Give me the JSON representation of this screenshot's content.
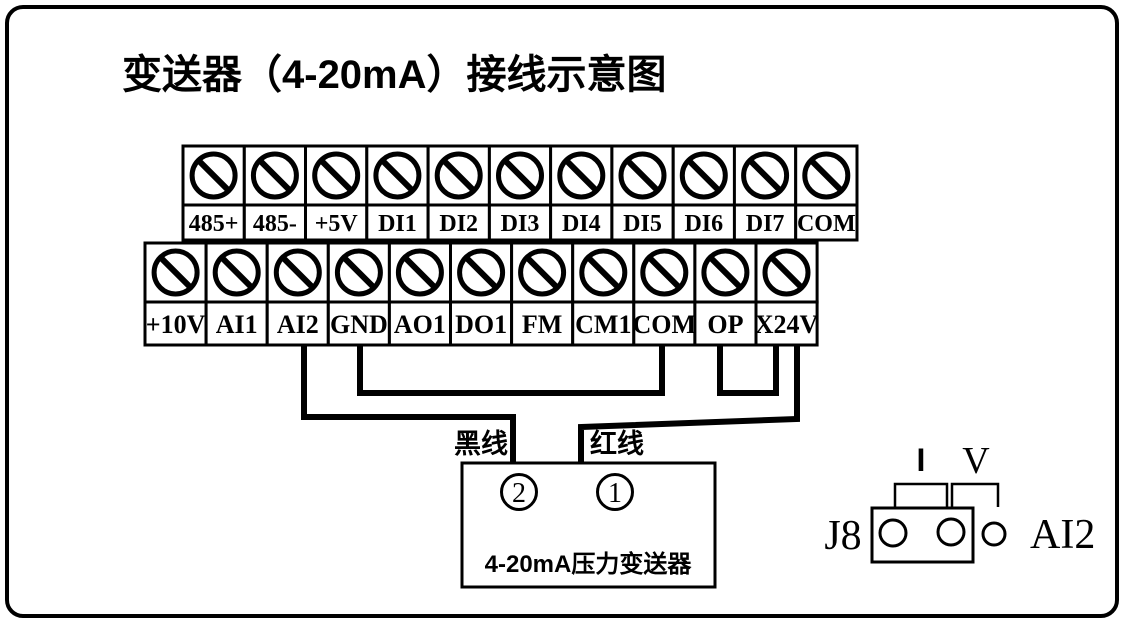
{
  "title": "变送器（4-20mA）接线示意图",
  "colors": {
    "line": "#000000",
    "background": "#ffffff"
  },
  "terminal_strips": {
    "top": {
      "terminals": [
        "485+",
        "485-",
        "+5V",
        "DI1",
        "DI2",
        "DI3",
        "DI4",
        "DI5",
        "DI6",
        "DI7",
        "COM"
      ]
    },
    "bottom": {
      "terminals": [
        "+10V",
        "AI1",
        "AI2",
        "GND",
        "AO1",
        "DO1",
        "FM",
        "CM1",
        "COM",
        "OP",
        "X24V"
      ]
    }
  },
  "wires": [
    {
      "name": "black-wire",
      "from": "AI2",
      "to": "transmitter-terminal-2",
      "label": "黑线"
    },
    {
      "name": "jumper-wire-gnd-com",
      "from": "GND",
      "to": "COM",
      "label": ""
    },
    {
      "name": "jumper-wire-op-x24v",
      "from": "OP",
      "to": "X24V",
      "label": ""
    },
    {
      "name": "red-wire",
      "from": "X24V",
      "to": "transmitter-terminal-1",
      "label": "红线"
    }
  ],
  "labels": {
    "black_wire": "黑线",
    "red_wire": "红线"
  },
  "transmitter": {
    "terminal_left": "2",
    "terminal_right": "1",
    "label": "4-20mA压力变送器"
  },
  "jumper_block": {
    "name_label": "J8",
    "mode_current": "I",
    "mode_voltage": "V",
    "channel_label": "AI2",
    "pins": 3,
    "cap_on_pins": "1-2 (I / current mode)"
  }
}
